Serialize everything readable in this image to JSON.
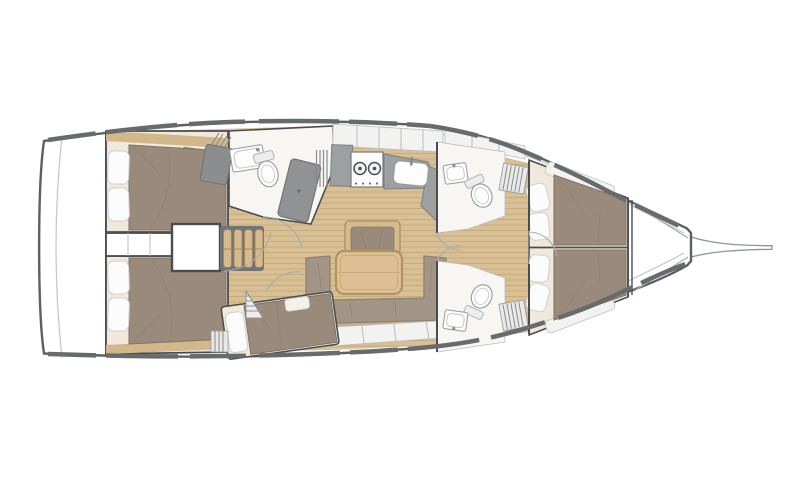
{
  "figure": {
    "type": "sailboat-interior-floor-plan",
    "orientation": "bow-right",
    "rooms": [
      "transom-platform",
      "aft-cabin-port",
      "aft-cabin-starboard",
      "engine-compartment",
      "companionway-steps",
      "aft-head-with-shower",
      "galley",
      "salon-dinette",
      "bunk-cabin",
      "forward-head-port",
      "forward-head-starboard",
      "forward-cabin-v-berth",
      "forepeak-anchor-locker",
      "bowsprit"
    ],
    "fixtures": [
      "double-bed",
      "pillow",
      "stove-2-burners",
      "galley-sink",
      "fridge-counter",
      "toilet",
      "washbasin",
      "shower-pan",
      "dining-table",
      "bench-seat",
      "u-shaped-sofa",
      "storage-locker",
      "louvered-locker",
      "door-swing-arc"
    ]
  },
  "colors": {
    "deck": "#ffffff",
    "hull_outline": "#5d6062",
    "toe_rail": "#686b6d",
    "inner_line": "#c3c6c7",
    "wall": "#4a4d4f",
    "panel_light": "#f2f2f1",
    "panel_divider": "#b9bcbd",
    "head_floor": "#f7f6f3",
    "wood_base": "#d8bf94",
    "wood_seam": "#c5a97a",
    "wood_trim": "#d2b78b",
    "wardrobe_wood": "#c9ae82",
    "mattress": "#9a8a7c",
    "mattress_edge": "#7e7164",
    "bedding_cream": "#efe8db",
    "pillow": "#fcfcfc",
    "pillow_edge": "#d0d0d0",
    "counter_gray": "#9da0a1",
    "counter_edge": "#7e8081",
    "shower_gray": "#909293",
    "shower_edge": "#707273",
    "fixture_white": "#fdfdfd",
    "fixture_edge": "#97999a",
    "table_wood": "#dcc094",
    "table_edge": "#b1935f",
    "sofa": "#a29585",
    "sofa_edge": "#8d8174",
    "step_tread": "#d6ba8c",
    "step_tread_edge": "#9c8159",
    "step_frame": "#717476",
    "arc": "#a8adaf",
    "slat": "#898b8c",
    "bowsprit_edge": "#8f9496"
  }
}
